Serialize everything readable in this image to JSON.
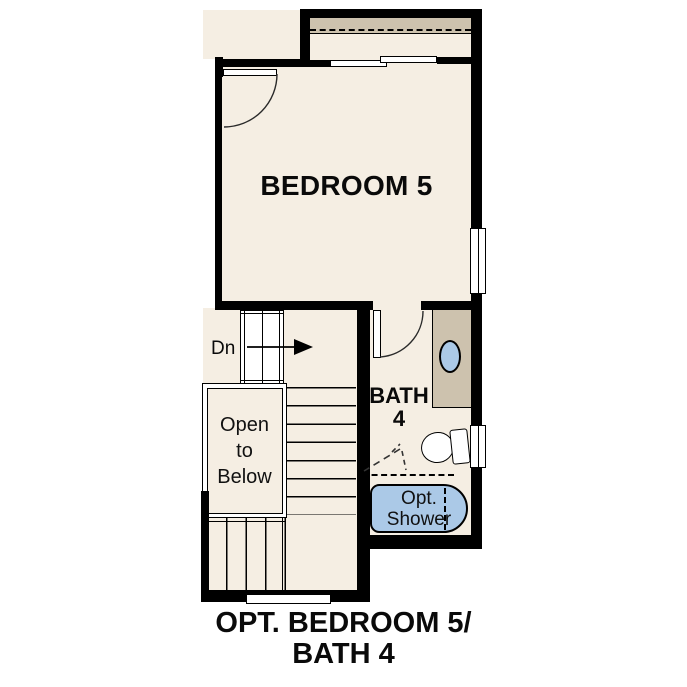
{
  "title": {
    "line1": "OPT. BEDROOM 5/",
    "line2": "BATH 4"
  },
  "labels": {
    "bedroom": "BEDROOM 5",
    "bath_line1": "BATH",
    "bath_line2": "4",
    "stairs_down": "Dn",
    "open_to_below_line1": "Open",
    "open_to_below_line2": "to",
    "open_to_below_line3": "Below",
    "opt_shower_line1": "Opt.",
    "opt_shower_line2": "Shower"
  },
  "fixtures": {
    "closet": "bypass-sliding-doors-with-shelf-and-rod",
    "entry_door": "hinged-door-swing-arc",
    "bath_door": "hinged-door-swing-arc",
    "windows": [
      "bedroom-right-wall-window",
      "bath-right-wall-window"
    ],
    "sink": "oval-vanity-sink",
    "toilet": "tank-and-bowl",
    "shower": "optional-tub-shower",
    "stairs": "switchback-stair-down"
  },
  "colors": {
    "background": "#ffffff",
    "wall": "#000000",
    "floor": "#f5eee3",
    "shelf": "#cdc2ae",
    "vanity": "#cdc2ae",
    "fixture_blue": "#abc9e7"
  }
}
